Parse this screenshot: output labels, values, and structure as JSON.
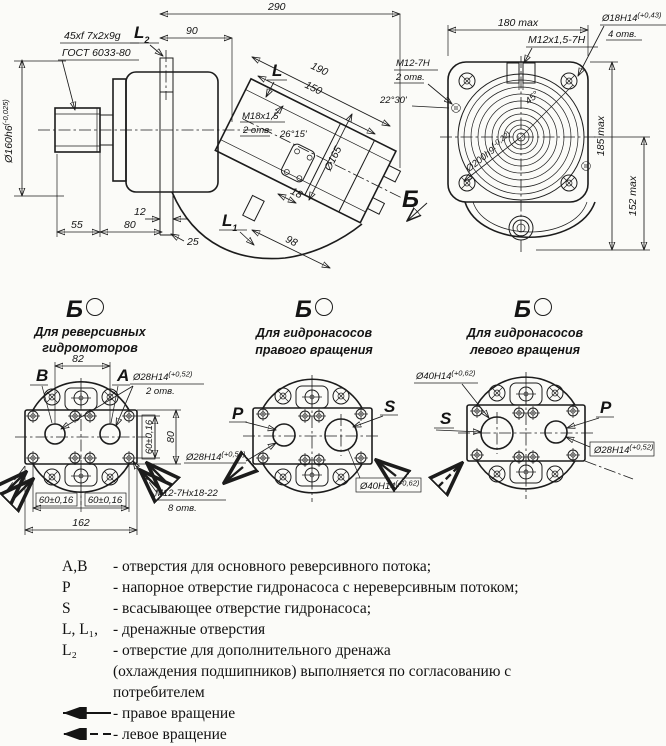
{
  "colors": {
    "ink": "#1c1c1c",
    "paper": "#fbfbf8"
  },
  "side_view": {
    "dim_290": "290",
    "dim_90": "90",
    "l2": "L",
    "l2_sub": "2",
    "spline_line1": "45xf 7x2x9g",
    "spline_line2": "ГОСТ 6033-80",
    "dia160": "Ø160h6",
    "dia160_tol": "(-0,025)",
    "dim_55": "55",
    "dim_80": "80",
    "dim_12": "12",
    "dim_25": "25",
    "l1": "L",
    "l1_sub": "1",
    "l": "L",
    "m18_line1": "M18x1,5",
    "m18_line2": "2 отв.",
    "angle_2615": "26°15'",
    "dim_190": "190",
    "dim_150": "150",
    "dia165": "Ø165",
    "dim_18": "18",
    "dim_98": "98",
    "view_b": "Б"
  },
  "front_view": {
    "dim_180": "180 max",
    "m12x15": "M12x1,5-7H",
    "dia18": "Ø18H14",
    "dia18_tol": "(+0,43)",
    "dia18_qty": "4 отв.",
    "m12_line1": "M12-7H",
    "m12_line2": "2 отв.",
    "angle_2230": "22°30'",
    "angle_45": "45°",
    "dia200": "Ø200h9",
    "dia200_tol": "(-0,22)",
    "dim_185": "185 max",
    "dim_152": "152 max"
  },
  "views": [
    {
      "label": "Б",
      "caption1": "Для реверсивных",
      "caption2": "гидромоторов",
      "port_left": "B",
      "port_right": "A",
      "dim_82": "82",
      "dia28": "Ø28H14",
      "dia28_tol": "(+0,52)",
      "dia28_qty": "2 отв.",
      "dim_60v": "60±0,16",
      "dim_80": "80",
      "dim_60a": "60±0,16",
      "dim_60b": "60±0,16",
      "dim_162": "162",
      "m12": "M12-7Hx18-22",
      "m12_qty": "8 отв."
    },
    {
      "label": "Б",
      "caption1": "Для гидронасосов",
      "caption2": "правого вращения",
      "port_left": "P",
      "port_right": "S",
      "dia28": "Ø28H14",
      "dia28_tol": "(+0,52)",
      "dia40": "Ø40H14",
      "dia40_tol": "(+0,62)"
    },
    {
      "label": "Б",
      "caption1": "Для гидронасосов",
      "caption2": "левого вращения",
      "port_left": "S",
      "port_right": "P",
      "dia28": "Ø28H14",
      "dia28_tol": "(+0,52)",
      "dia40": "Ø40H14",
      "dia40_tol": "(+0,62)"
    }
  ],
  "legend": {
    "rows": [
      {
        "sym": "А,В",
        "text": "- отверстия для основного реверсивного потока;"
      },
      {
        "sym": "Р",
        "text": "- напорное отверстие гидронасоса с нереверсивным потоком;"
      },
      {
        "sym": "S",
        "text": "- всасывающее  отверстие гидронасоса;"
      },
      {
        "sym": "L, L₁,",
        "text": "- дренажные отверстия"
      },
      {
        "sym": "L₂",
        "text": "- отверстие для дополнительного дренажа"
      },
      {
        "sym": "",
        "text": "(охлаждения подшипников) выполняется по согласованию с"
      },
      {
        "sym": "",
        "text": "потребителем"
      }
    ],
    "right_rotation": "- правое вращение",
    "left_rotation": "- левое вращение"
  }
}
